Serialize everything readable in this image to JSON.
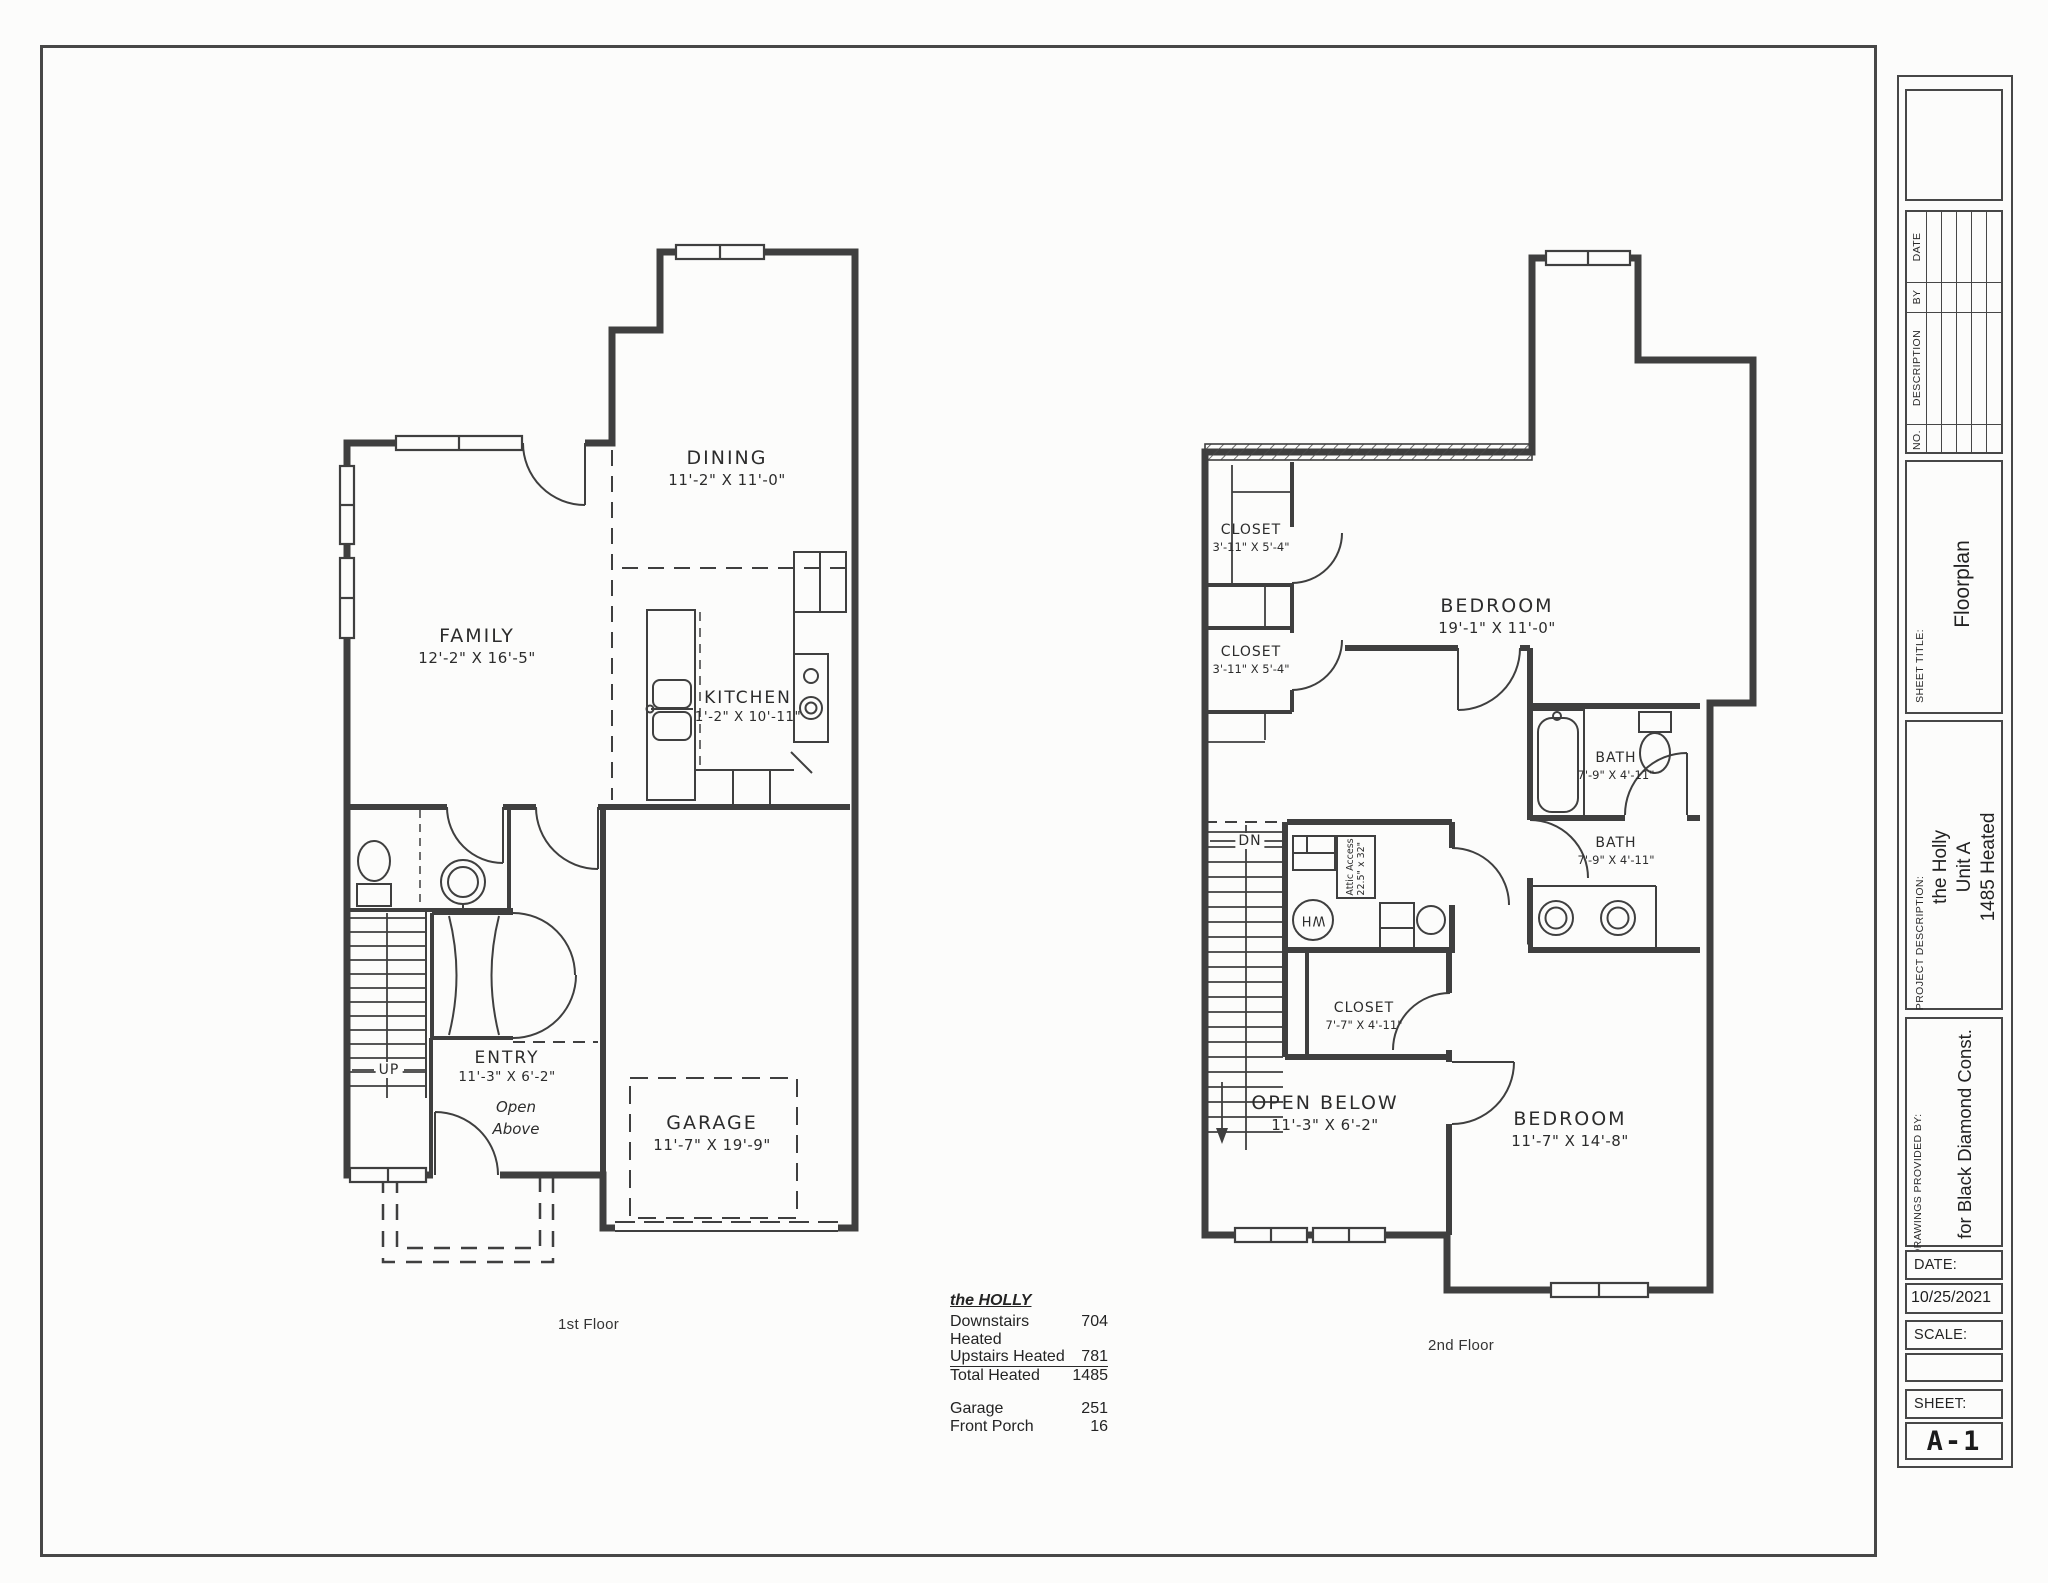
{
  "colors": {
    "ink": "#3f3f3f",
    "paper": "#fcfcfb"
  },
  "first_floor": {
    "caption": "1st Floor",
    "rooms": {
      "family": {
        "name": "FAMILY",
        "dims": "12'-2\" X 16'-5\""
      },
      "dining": {
        "name": "DINING",
        "dims": "11'-2\" X 11'-0\""
      },
      "kitchen": {
        "name": "KITCHEN",
        "dims": "1'-2\" X 10'-11\""
      },
      "entry": {
        "name": "ENTRY",
        "dims": "11'-3\" X 6'-2\""
      },
      "garage": {
        "name": "GARAGE",
        "dims": "11'-7\" X 19'-9\""
      }
    },
    "notes": {
      "up": "UP",
      "open_above_1": "Open",
      "open_above_2": "Above"
    }
  },
  "second_floor": {
    "caption": "2nd Floor",
    "rooms": {
      "closet_a": {
        "name": "CLOSET",
        "dims": "3'-11\" X 5'-4\""
      },
      "closet_b": {
        "name": "CLOSET",
        "dims": "3'-11\" X 5'-4\""
      },
      "bedroom_main": {
        "name": "BEDROOM",
        "dims": "19'-1\" X 11'-0\""
      },
      "bath_a": {
        "name": "BATH",
        "dims": "7'-9\" X 4'-11\""
      },
      "bath_b": {
        "name": "BATH",
        "dims": "7'-9\" X 4'-11\""
      },
      "closet_c": {
        "name": "CLOSET",
        "dims": "7'-7\" X 4'-11\""
      },
      "open_below": {
        "name": "OPEN BELOW",
        "dims": "11'-3\" X 6'-2\""
      },
      "bedroom_b": {
        "name": "BEDROOM",
        "dims": "11'-7\" X 14'-8\""
      }
    },
    "notes": {
      "dn": "DN",
      "wh": "WH",
      "attic_1": "Attic Access",
      "attic_2": "22.5\" x 32\""
    }
  },
  "summary": {
    "title": "the HOLLY",
    "rows": [
      {
        "label": "Downstairs Heated",
        "value": "704"
      },
      {
        "label": "Upstairs Heated",
        "value": "781"
      },
      {
        "label": "Total Heated",
        "value": "1485"
      },
      {
        "label": "Garage",
        "value": "251"
      },
      {
        "label": "Front Porch",
        "value": "16"
      }
    ]
  },
  "title_block": {
    "revision": {
      "no": "NO.",
      "description": "DESCRIPTION",
      "by": "BY",
      "date": "DATE"
    },
    "sheet_title_label": "SHEET TITLE:",
    "sheet_title": "Floorplan",
    "project_label": "PROJECT DESCRIPTION:",
    "project_lines": [
      "the Holly",
      "Unit A",
      "1485 Heated"
    ],
    "provided_label": "DRAWINGS PROVIDED BY:",
    "provided_by": "for Black Diamond Const.",
    "date_label": "DATE:",
    "date_value": "10/25/2021",
    "scale_label": "SCALE:",
    "sheet_label": "SHEET:",
    "sheet_number": "A-1"
  }
}
